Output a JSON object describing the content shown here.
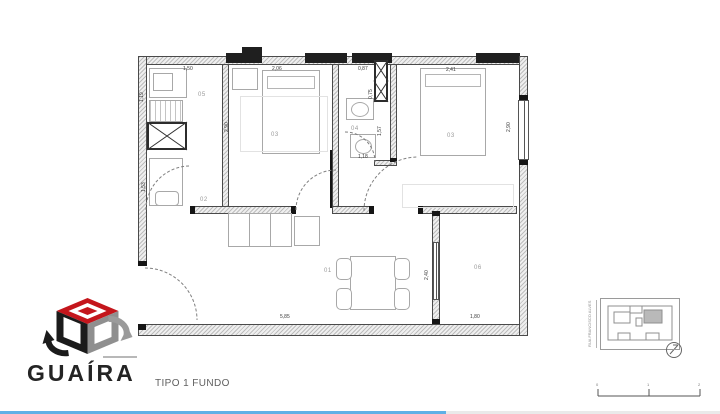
{
  "page": {
    "caption": "TIPO 1 FUNDO"
  },
  "logo": {
    "name": "GUAÍRA"
  },
  "colors": {
    "logo_red": "#c4161c",
    "logo_black": "#1b1b1b",
    "logo_gray": "#8f8f8f",
    "wall_line": "#3a3a3a",
    "dim_text": "#3a3a3a",
    "progress_blue": "#5fb0e6"
  },
  "icons": {
    "logo_mark": "cube-arrows-icon",
    "north_arrow": "north-arrow-icon"
  },
  "plan": {
    "rooms": {
      "living": "01",
      "service": "02",
      "bedroom_mid": "03",
      "bedroom_right": "03",
      "bathroom": "04",
      "kitchen": "05",
      "terrace": "06"
    },
    "dims": {
      "top_kitchen": "1,50",
      "top_bedroom_mid": "2,06",
      "top_bath": "0,87",
      "top_bedroom_right": "2,41",
      "left_upper": "1,19",
      "left_lower": "1,53",
      "bedroom_mid_height": "2,90",
      "bedroom_right_height": "2,90",
      "bath_upper": "0,75",
      "bath_inner": "1,57",
      "bath_width": "1,18",
      "terrace_height": "2,40",
      "bottom_living": "5,85",
      "bottom_terrace": "1,80"
    }
  },
  "keyplan": {
    "street": "RUA FRANCISCO ALVES"
  },
  "scalebar": {
    "tick_0": "0",
    "tick_1": "1",
    "tick_2": "2"
  }
}
